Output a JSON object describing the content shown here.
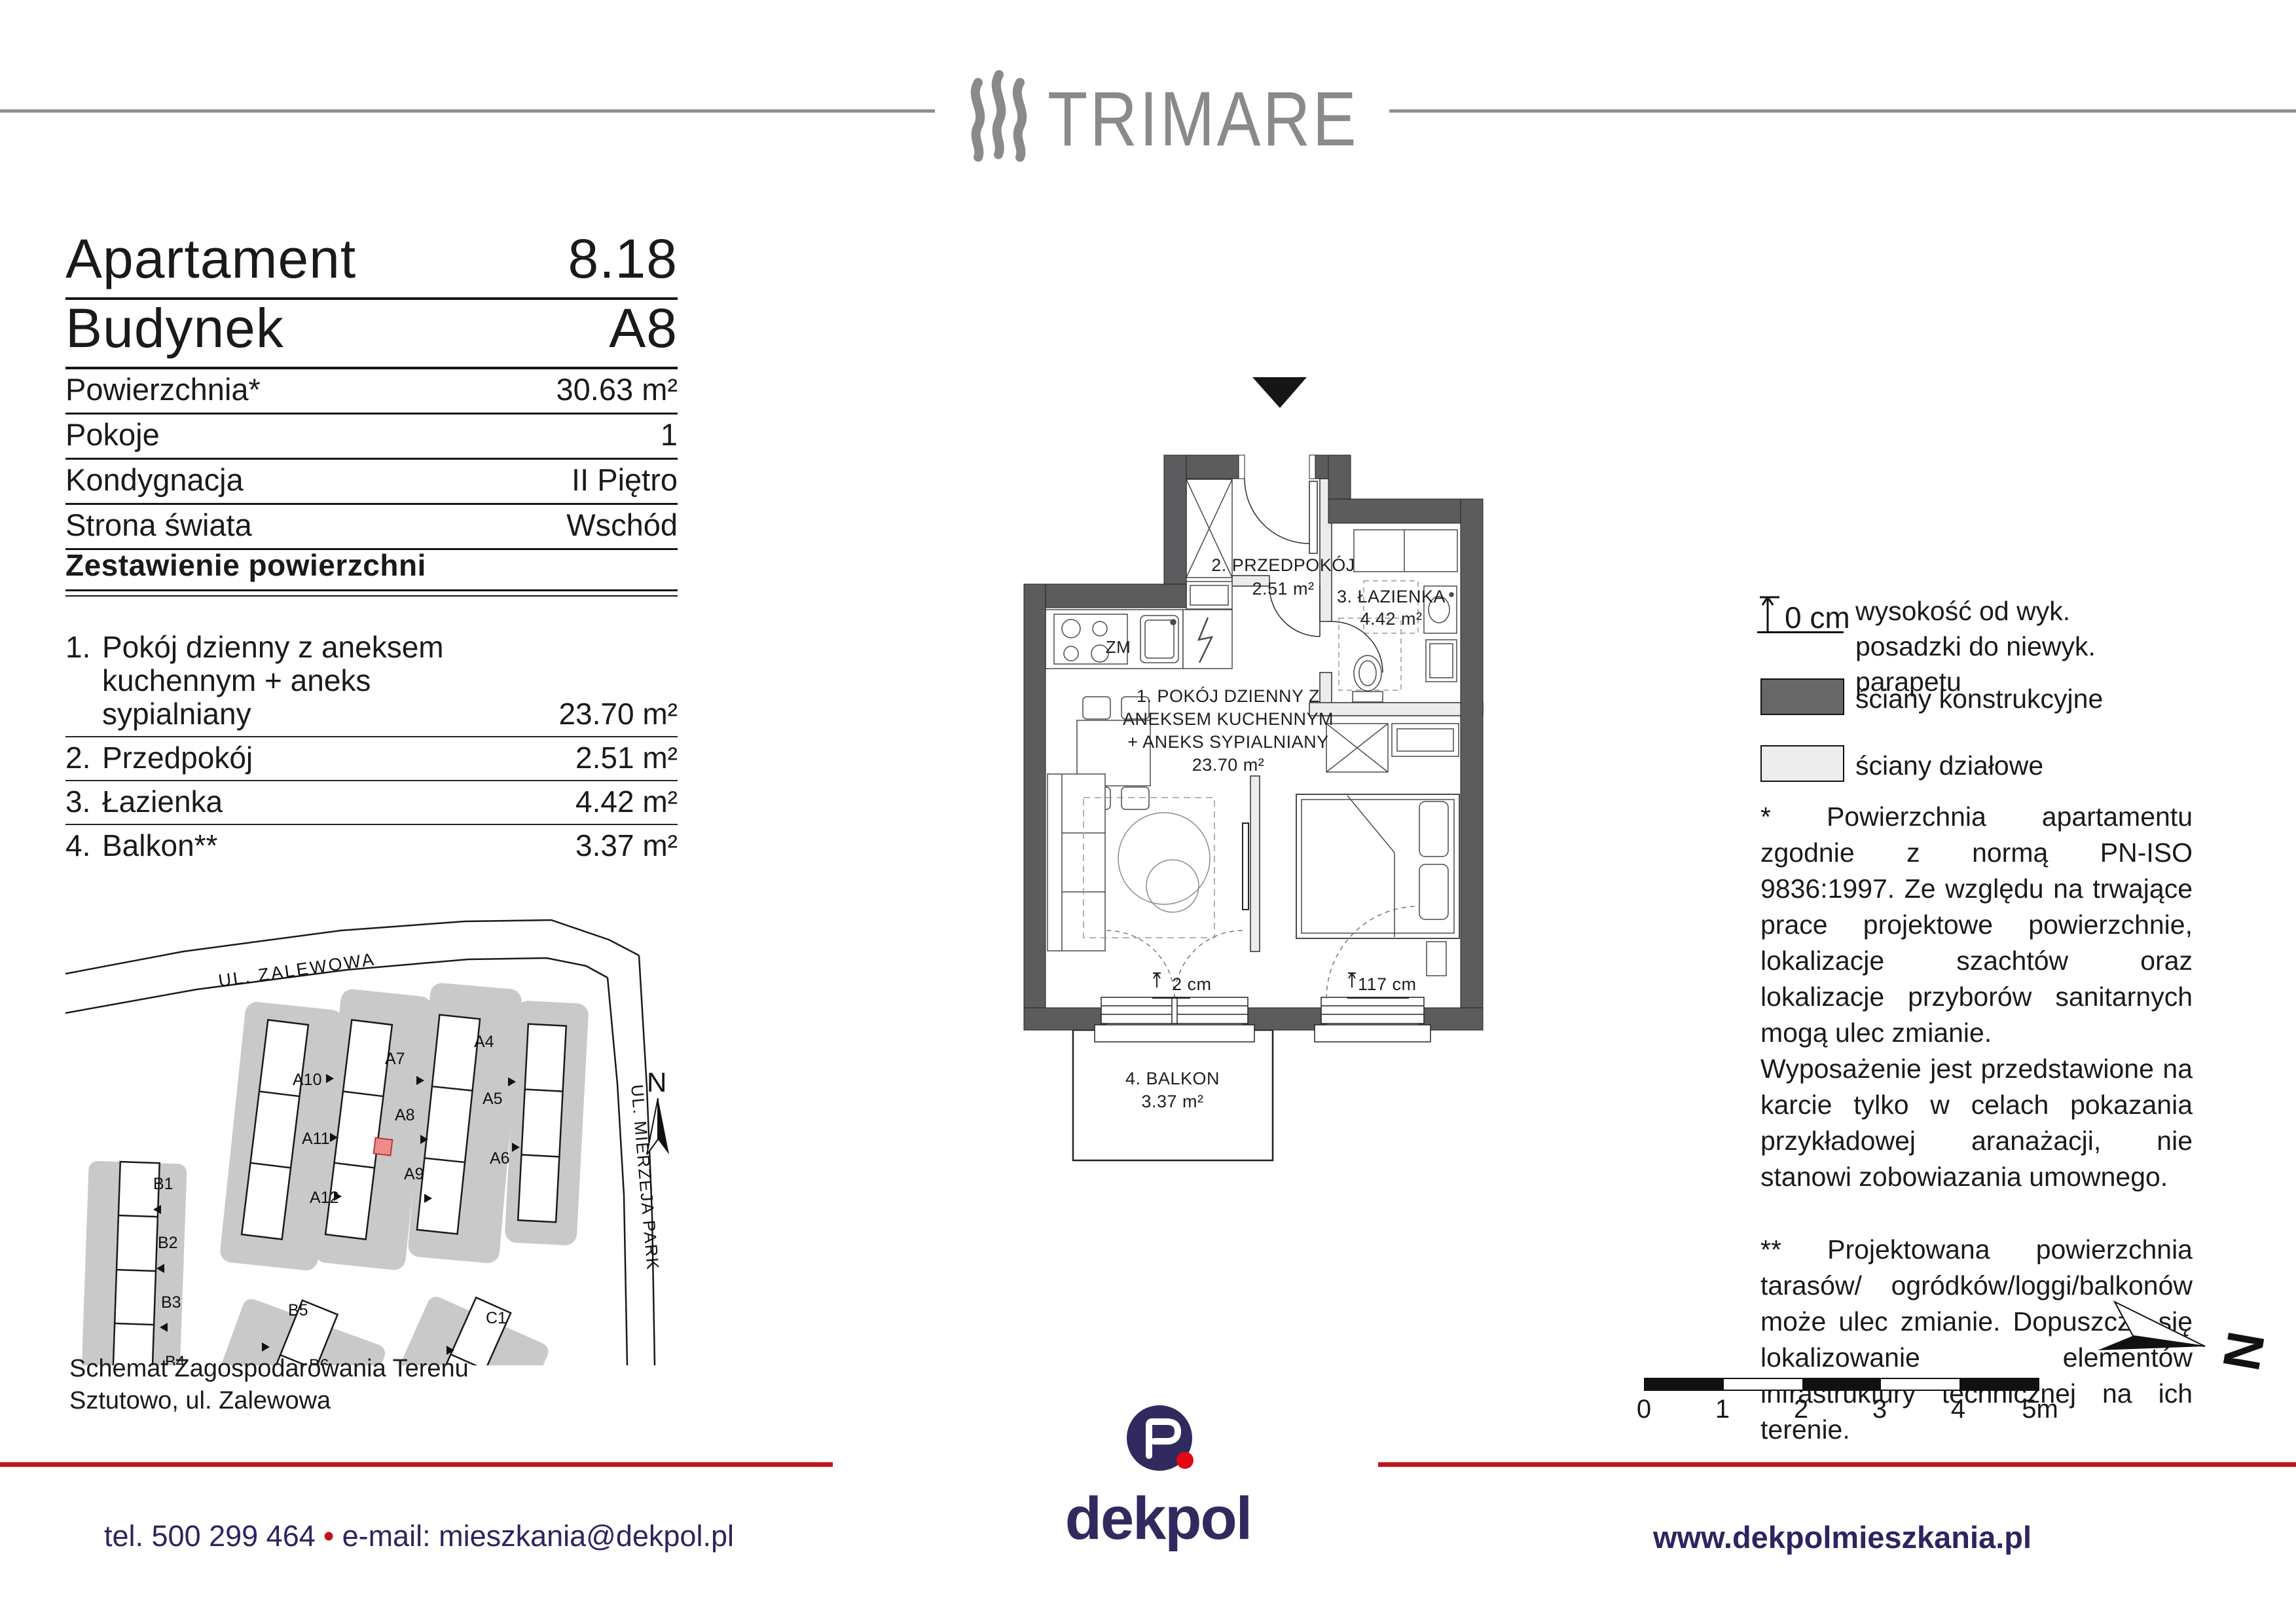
{
  "header": {
    "brand": "TRIMARE"
  },
  "apartment": {
    "rows_large": [
      {
        "label": "Apartament",
        "value": "8.18"
      },
      {
        "label": "Budynek",
        "value": "A8"
      }
    ],
    "rows_small": [
      {
        "label": "Powierzchnia*",
        "value": "30.63 m²"
      },
      {
        "label": "Pokoje",
        "value": "1"
      },
      {
        "label": "Kondygnacja",
        "value": "II Piętro"
      },
      {
        "label": "Strona świata",
        "value": "Wschód"
      }
    ]
  },
  "areas": {
    "title": "Zestawienie powierzchni",
    "items": [
      {
        "no": "1.",
        "name": "Pokój dzienny z aneksem kuchennym + aneks sypialniany",
        "value": "23.70 m²"
      },
      {
        "no": "2.",
        "name": "Przedpokój",
        "value": "2.51 m²"
      },
      {
        "no": "3.",
        "name": "Łazienka",
        "value": "4.42 m²"
      },
      {
        "no": "4.",
        "name": "Balkon**",
        "value": "3.37 m²"
      }
    ]
  },
  "floor_plan": {
    "living": {
      "l1": "1.  POKÓJ DZIENNY Z",
      "l2": "ANEKSEM KUCHENNYM",
      "l3": "+ ANEKS SYPIALNIANY",
      "area": "23.70 m²"
    },
    "hall": {
      "l1": "2.  PRZEDPOKÓJ",
      "area": "2.51 m²"
    },
    "bath": {
      "l1": "3.  ŁAZIENKA",
      "area": "4.42 m²"
    },
    "balcony": {
      "l1": "4. BALKON",
      "area": "3.37 m²"
    },
    "kitchen_label": "ZM",
    "dim_balcony_door": "2 cm",
    "dim_bedroom_window": "117 cm"
  },
  "site_plan": {
    "streets": {
      "zalewowa": "UL. ZALEWOWA",
      "mierzeja": "UL. MIERZEJA PARK"
    },
    "buildings": {
      "a4": "A4",
      "a5": "A5",
      "a6": "A6",
      "a7": "A7",
      "a8": "A8",
      "a9": "A9",
      "a10": "A10",
      "a11": "A11",
      "a12": "A12",
      "b1": "B1",
      "b2": "B2",
      "b3": "B3",
      "b4": "B4",
      "b5": "B5",
      "b6": "B6",
      "c1": "C1",
      "c2": "C2"
    },
    "north": "N",
    "caption1": "Schemat Zagospodarowania Terenu",
    "caption2": "Sztutowo, ul. Zalewowa",
    "highlight_color": "#ef8b8b"
  },
  "legend": {
    "height_value": "0 cm",
    "height_text": "wysokość od wyk. posadzki do niewyk. parapetu",
    "structural": "ściany konstrukcyjne",
    "partition": "ściany działowe"
  },
  "notes": {
    "p1a": "*  Powierzchnia apartamentu zgodnie z normą PN-ISO 9836:1997. Ze względu na trwające prace projektowe powierzchnie, lokalizacje szachtów oraz lokalizacje przyborów sanitarnych mogą ulec zmianie.",
    "p1b": "Wyposażenie jest przedstawione na karcie tylko w celach pokazania przykładowej aranażacji, nie stanowi zobowiazania umownego.",
    "p2": "**  Projektowana powierzchnia tarasów/ ogródków/loggi/balkonów może ulec zmianie. Dopuszcza się lokalizowanie elementów infrastruktury technicznej na ich terenie."
  },
  "scale_bar": {
    "labels": [
      "0",
      "1",
      "2",
      "3",
      "4",
      "5m"
    ]
  },
  "compass": {
    "north": "N"
  },
  "footer": {
    "tel": "tel. 500 299 464",
    "separator": "•",
    "email": "e-mail: mieszkania@dekpol.pl",
    "website": "www.dekpolmieszkania.pl",
    "logo_word": "dekpol",
    "accent_color": "#c41218",
    "navy_color": "#2b2660"
  }
}
